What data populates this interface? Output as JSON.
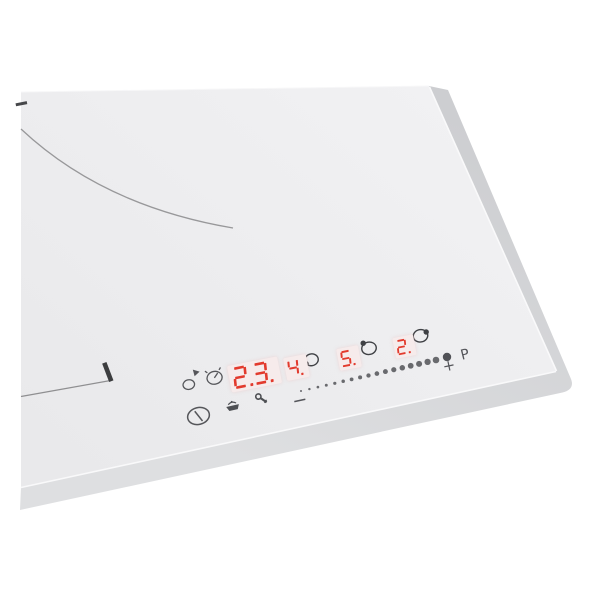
{
  "product": {
    "kind": "white glass induction hob, corner view with touch control panel"
  },
  "colors": {
    "background": "#ffffff",
    "glass": "#ededee",
    "bevel": "#d6d7da",
    "digit_red": "#e23a2d",
    "display_bg": "#f6ebeb",
    "icon_gray": "#55565a",
    "marking_gray": "#98989a"
  },
  "control_panel": {
    "timer_display": {
      "value": "2.3."
    },
    "zone_displays": [
      {
        "value": "4.",
        "indicator_dot": "bottom-left"
      },
      {
        "value": "5.",
        "indicator_dot": "top-left"
      },
      {
        "value": "2.",
        "indicator_dot": "top-right"
      }
    ],
    "slider": {
      "minus_label": "−",
      "plus_label": "+",
      "boost_label": "P",
      "dot_count": 17
    },
    "icons": [
      "power-icon",
      "heat-up-icon",
      "timer-clock-icon",
      "keep-warm-icon",
      "child-lock-key-icon"
    ]
  },
  "markings": {
    "zone_arc": "partial cooking-zone circle at top-left",
    "zone_line": "thin zone edge line at lower-left",
    "zone_tick": "thick zone marker tick",
    "edge_dash": "small dark dash on left edge"
  }
}
